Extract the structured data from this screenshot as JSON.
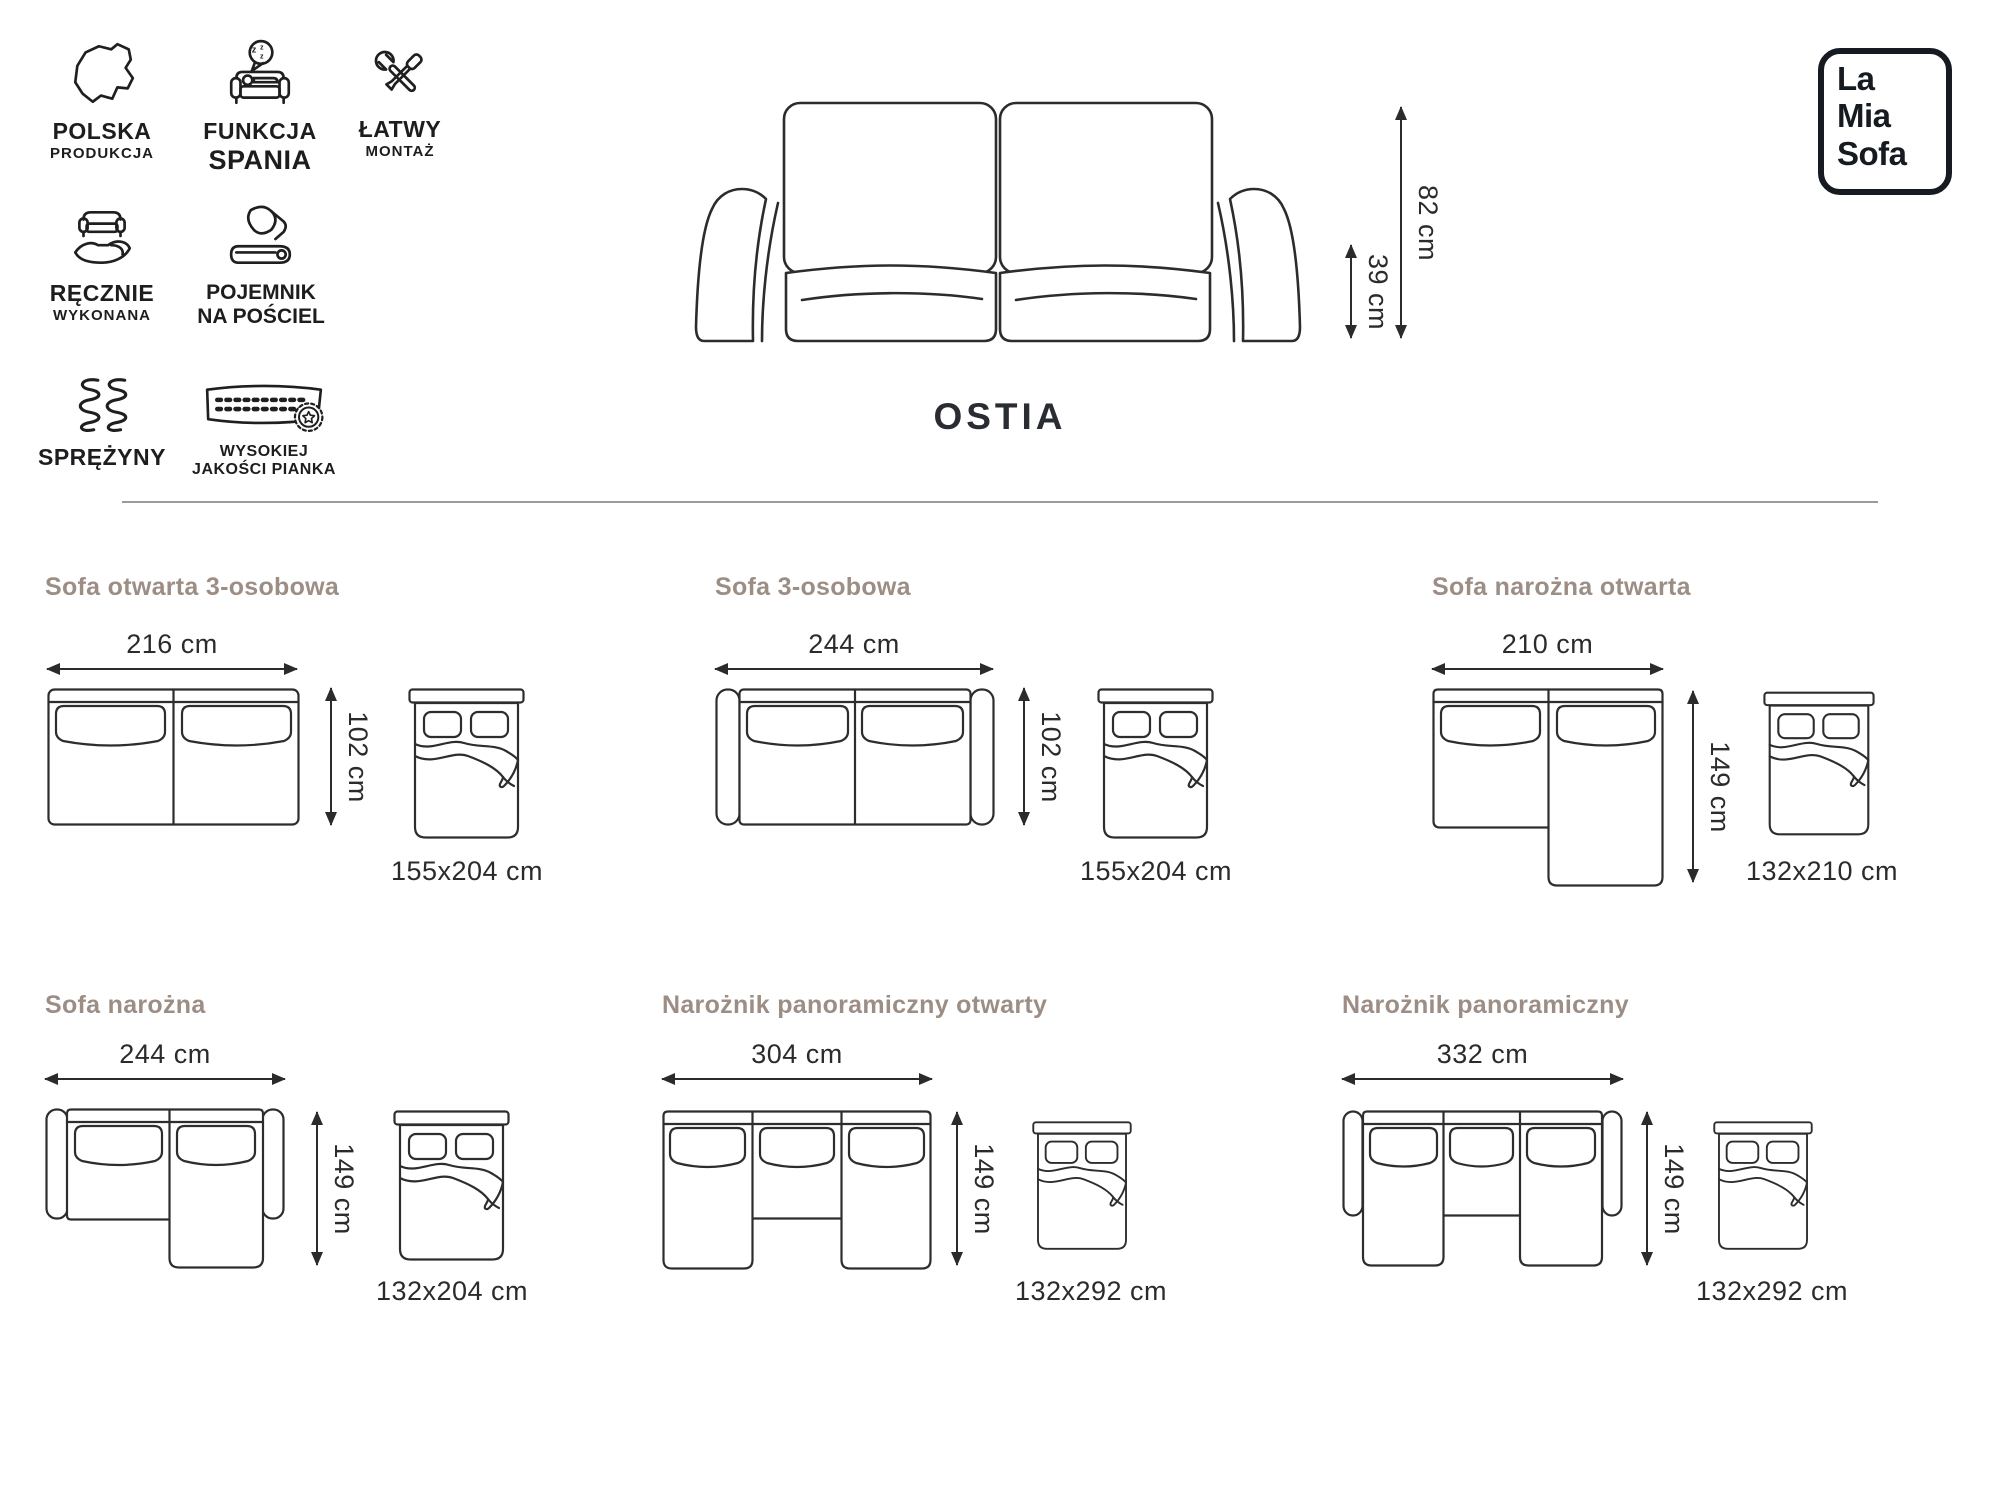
{
  "logo": {
    "lines": [
      "La",
      "Mia",
      "Sofa"
    ]
  },
  "product": {
    "name": "OSTIA"
  },
  "front_view": {
    "height_label": "82 cm",
    "seat_height_label": "39 cm"
  },
  "features": [
    {
      "icon": "poland-map-icon",
      "line1": "POLSKA",
      "line2": "PRODUKCJA"
    },
    {
      "icon": "sleep-function-icon",
      "line1": "FUNKCJA",
      "line2": "SPANIA",
      "zzz": [
        "z",
        "z",
        "z"
      ]
    },
    {
      "icon": "easy-assembly-icon",
      "line1": "ŁATWY",
      "line2": "MONTAŻ"
    },
    {
      "icon": "handmade-icon",
      "line1": "RĘCZNIE",
      "line2": "WYKONANA"
    },
    {
      "icon": "bedding-storage-icon",
      "line1": "POJEMNIK",
      "line2": "NA POŚCIEL"
    },
    {
      "icon": "springs-icon",
      "line1": "SPRĘŻYNY",
      "line2": ""
    },
    {
      "icon": "foam-quality-icon",
      "line1": "WYSOKIEJ",
      "line2": "JAKOŚCI PIANKA"
    }
  ],
  "configurations": [
    {
      "title": "Sofa otwarta 3-osobowa",
      "width_label": "216 cm",
      "depth_label": "102 cm",
      "bed_label": "155x204 cm"
    },
    {
      "title": "Sofa 3-osobowa",
      "width_label": "244 cm",
      "depth_label": "102 cm",
      "bed_label": "155x204 cm"
    },
    {
      "title": "Sofa narożna otwarta",
      "width_label": "210 cm",
      "depth_label": "149 cm",
      "bed_label": "132x210 cm"
    },
    {
      "title": "Sofa narożna",
      "width_label": "244 cm",
      "depth_label": "149 cm",
      "bed_label": "132x204 cm"
    },
    {
      "title": "Narożnik panoramiczny otwarty",
      "width_label": "304 cm",
      "depth_label": "149 cm",
      "bed_label": "132x292 cm"
    },
    {
      "title": "Narożnik panoramiczny",
      "width_label": "332 cm",
      "depth_label": "149 cm",
      "bed_label": "132x292 cm"
    }
  ],
  "colors": {
    "accent_title": "#9c8e85",
    "line": "#2d2d2d",
    "text": "#1d1d1f"
  }
}
